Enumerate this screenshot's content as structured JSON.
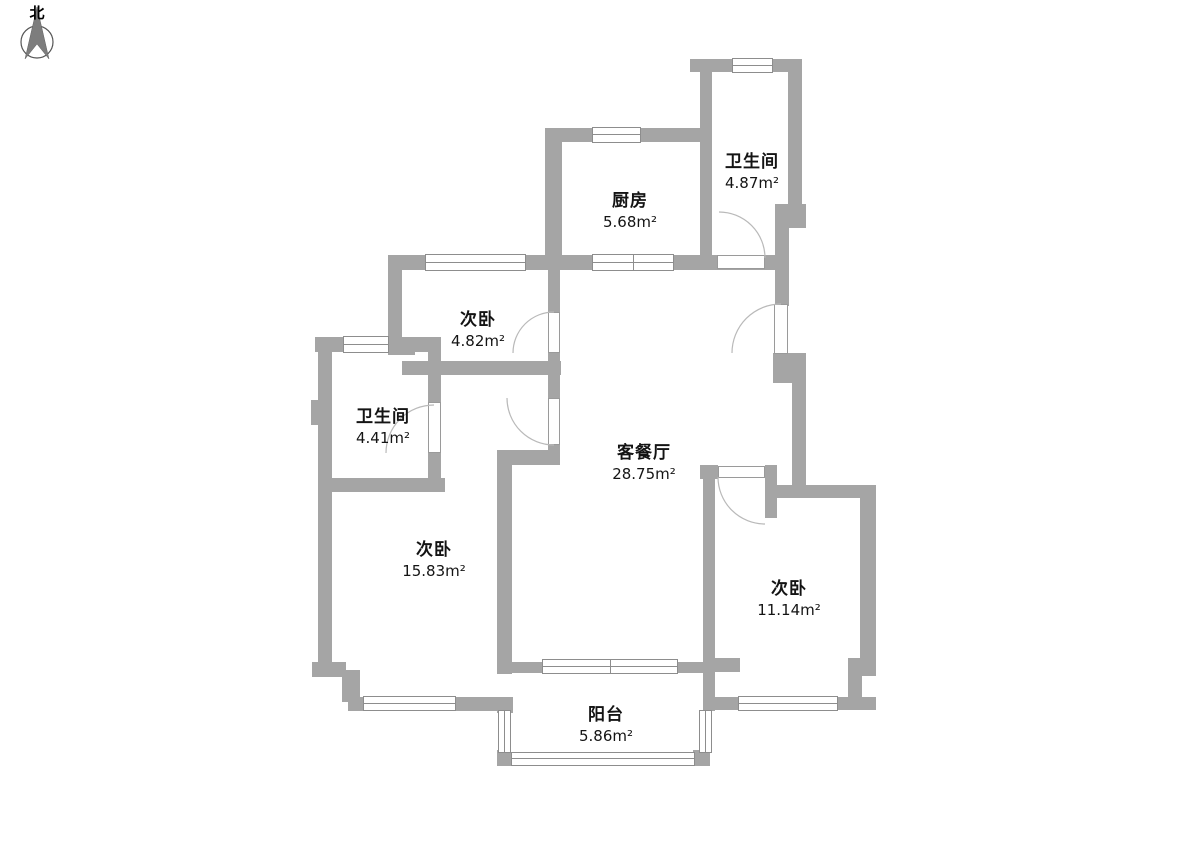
{
  "compass": {
    "label": "北"
  },
  "colors": {
    "wall": "#a5a5a5",
    "text": "#141414",
    "door_arc": "#b9b9b9"
  },
  "rooms": [
    {
      "id": "kitchen",
      "name": "厨房",
      "area": "5.68m²"
    },
    {
      "id": "bathroom-top",
      "name": "卫生间",
      "area": "4.87m²"
    },
    {
      "id": "bedroom-small",
      "name": "次卧",
      "area": "4.82m²"
    },
    {
      "id": "bathroom-left",
      "name": "卫生间",
      "area": "4.41m²"
    },
    {
      "id": "living-dining",
      "name": "客餐厅",
      "area": "28.75m²"
    },
    {
      "id": "bedroom-left",
      "name": "次卧",
      "area": "15.83m²"
    },
    {
      "id": "bedroom-right",
      "name": "次卧",
      "area": "11.14m²"
    },
    {
      "id": "balcony",
      "name": "阳台",
      "area": "5.86m²"
    }
  ]
}
